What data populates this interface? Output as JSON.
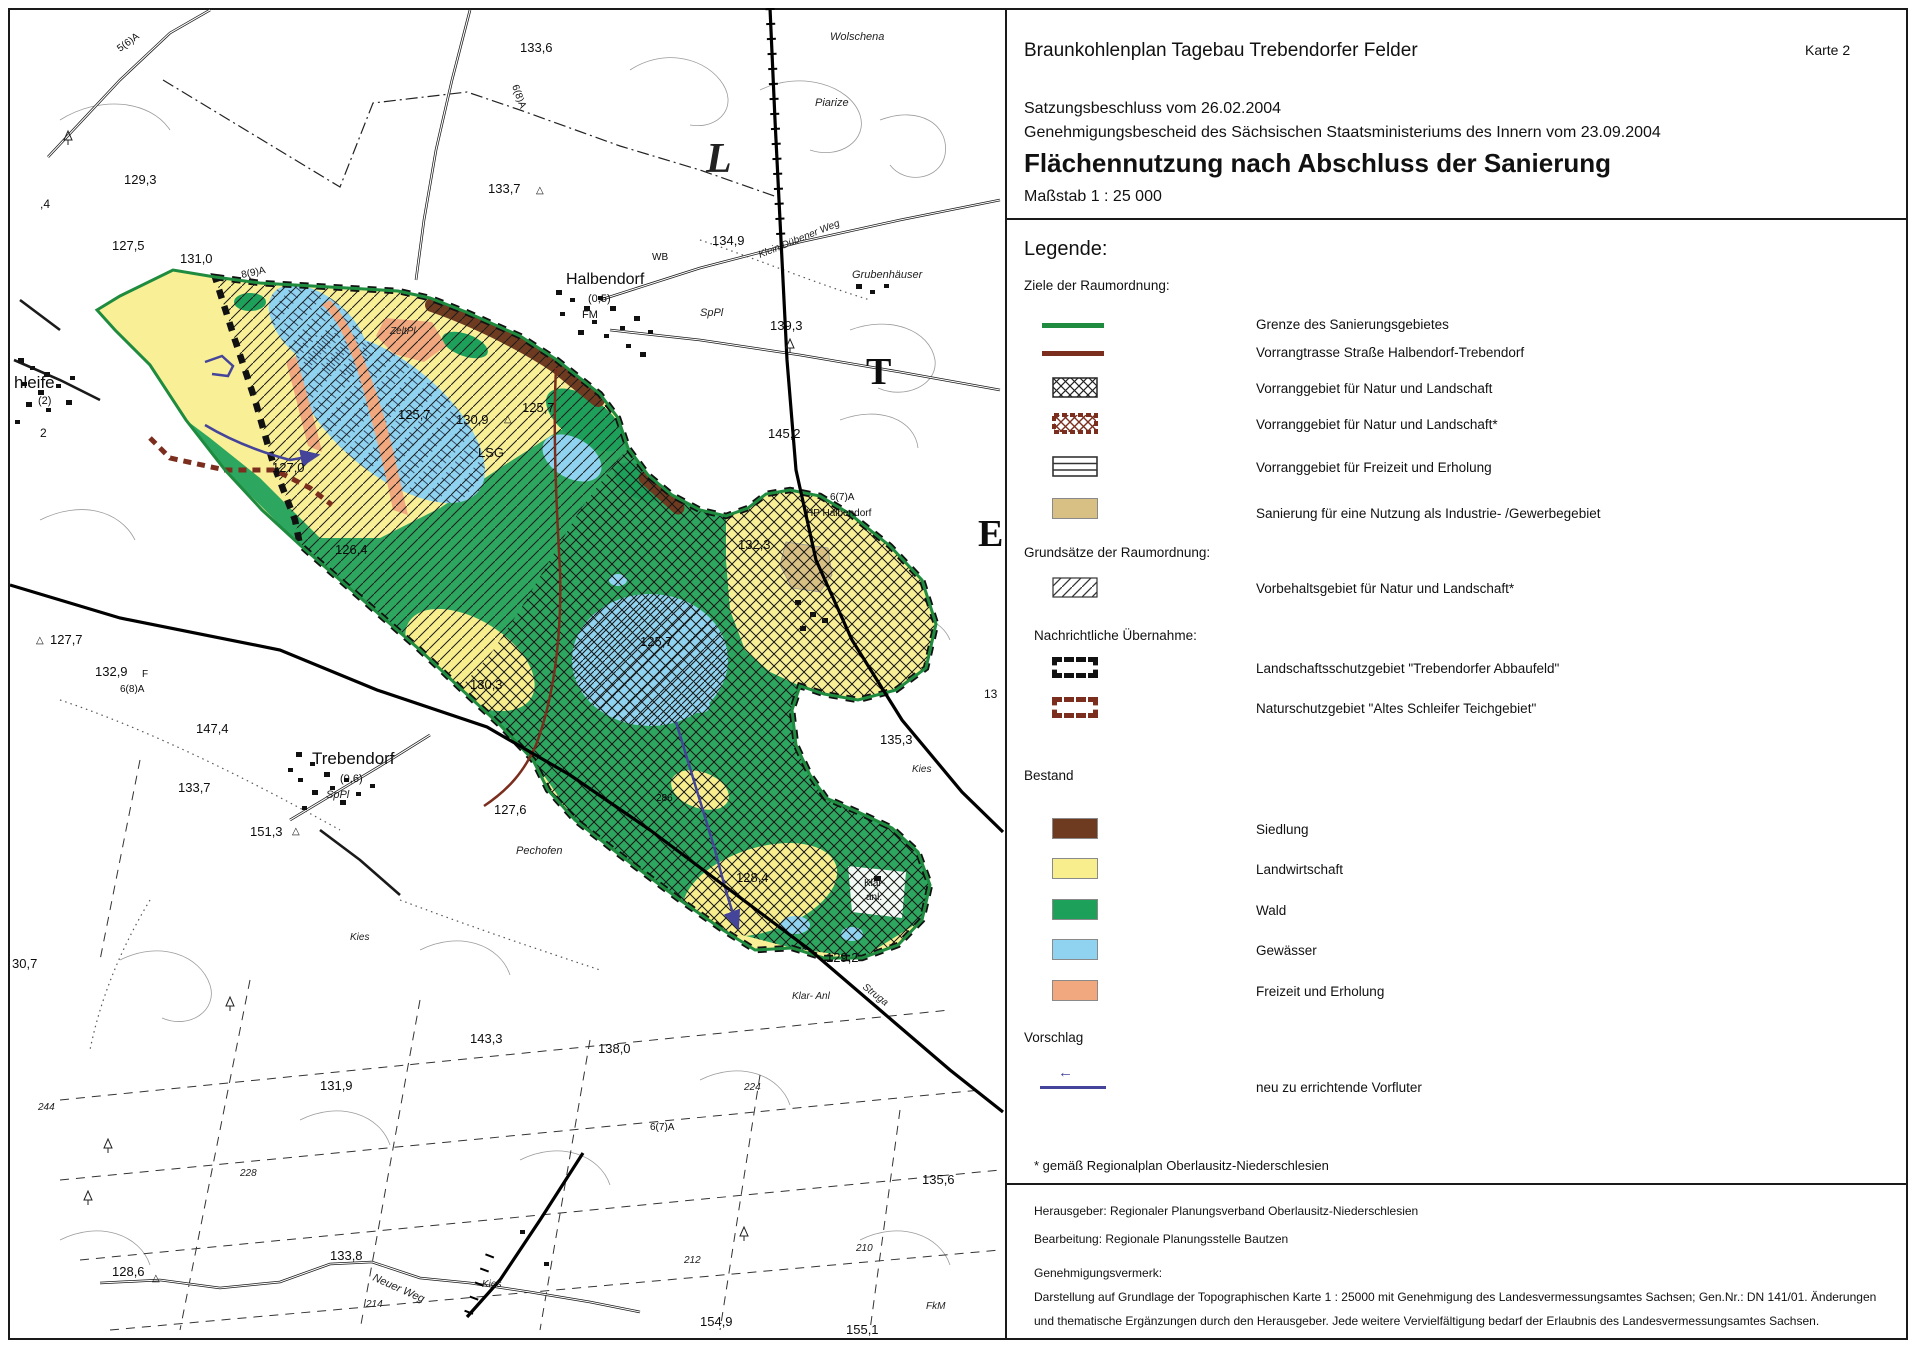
{
  "header": {
    "title": "Braunkohlenplan Tagebau Trebendorfer Felder",
    "karte": "Karte 2",
    "line1": "Satzungsbeschluss vom 26.02.2004",
    "line2": "Genehmigungsbescheid des Sächsischen Staatsministeriums des Innern vom 23.09.2004",
    "subject": "Flächennutzung nach Abschluss der Sanierung",
    "scale": "Maßstab 1 : 25 000"
  },
  "legend": {
    "heading": "Legende:",
    "ziele_heading": "Ziele der Raumordnung:",
    "grenze": "Grenze des Sanierungsgebietes",
    "vorrangtrasse": "Vorrangtrasse Straße Halbendorf-Trebendorf",
    "vorrang_natur": "Vorranggebiet für Natur und Landschaft",
    "vorrang_natur_star": "Vorranggebiet für Natur und Landschaft*",
    "vorrang_freizeit": "Vorranggebiet für Freizeit und Erholung",
    "sanierung_industrie": "Sanierung für eine Nutzung als Industrie- /Gewerbegebiet",
    "grundsaetze_heading": "Grundsätze der Raumordnung:",
    "vorbehalt": "Vorbehaltsgebiet für Natur und Landschaft*",
    "nachrichtlich_heading": "Nachrichtliche Übernahme:",
    "lsg": "Landschaftsschutzgebiet \"Trebendorfer Abbaufeld\"",
    "nsg": "Naturschutzgebiet \"Altes Schleifer Teichgebiet\"",
    "bestand_heading": "Bestand",
    "siedlung": "Siedlung",
    "landwirtschaft": "Landwirtschaft",
    "wald": "Wald",
    "gewaesser": "Gewässer",
    "freizeit": "Freizeit und Erholung",
    "vorschlag_heading": "Vorschlag",
    "vorfluter": "neu zu errichtende Vorfluter",
    "footnote": "* gemäß Regionalplan Oberlausitz-Niederschlesien"
  },
  "imprint": {
    "line1": "Herausgeber: Regionaler Planungsverband Oberlausitz-Niederschlesien",
    "line2": "Bearbeitung: Regionale Planungsstelle Bautzen",
    "line3": "Genehmigungsvermerk:",
    "line4": "Darstellung auf Grundlage der Topographischen Karte 1 : 25000 mit Genehmigung des Landesvermessungsamtes Sachsen; Gen.Nr.: DN 141/01. Änderungen",
    "line5": "und thematische Ergänzungen durch den Herausgeber. Jede weitere Vervielfältigung bedarf der Erlaubnis des Landesvermessungsamtes Sachsen."
  },
  "colors": {
    "grenze": "#1e8b3f",
    "trasse": "#7b2e1d",
    "wald": "#1da05a",
    "landwirtschaft": "#f8ee8e",
    "gewaesser": "#90d3f0",
    "freizeit": "#f2a87e",
    "siedlung": "#6e3a20",
    "industrie": "#d8c085",
    "vorfluter": "#44449a"
  },
  "map": {
    "labels": [
      {
        "t": "133,6",
        "x": 520,
        "y": 52
      },
      {
        "t": "Wolschena",
        "x": 830,
        "y": 40,
        "fs": 11,
        "it": 1
      },
      {
        "t": "Piarize",
        "x": 815,
        "y": 106,
        "fs": 11,
        "it": 1
      },
      {
        "t": "133,7",
        "x": 488,
        "y": 193
      },
      {
        "t": "△",
        "x": 536,
        "y": 193,
        "fs": 10
      },
      {
        "t": "134,9",
        "x": 712,
        "y": 245
      },
      {
        "t": "Klein Dübener Weg",
        "x": 760,
        "y": 258,
        "fs": 10,
        "it": 1,
        "rot": -22
      },
      {
        "t": "WB",
        "x": 652,
        "y": 260,
        "fs": 10
      },
      {
        "t": "Halbendorf",
        "x": 566,
        "y": 284,
        "fs": 16
      },
      {
        "t": "(0,5)",
        "x": 588,
        "y": 302,
        "fs": 11
      },
      {
        "t": "FM",
        "x": 582,
        "y": 318,
        "fs": 11
      },
      {
        "t": "SpPl",
        "x": 700,
        "y": 316,
        "fs": 11,
        "it": 1
      },
      {
        "t": "139,3",
        "x": 770,
        "y": 330
      },
      {
        "t": "Grubenhäuser",
        "x": 852,
        "y": 278,
        "fs": 11,
        "it": 1
      },
      {
        "t": "129,3",
        "x": 124,
        "y": 184
      },
      {
        "t": "127,5",
        "x": 112,
        "y": 250
      },
      {
        "t": "131,0",
        "x": 180,
        "y": 263
      },
      {
        "t": "5(6)A",
        "x": 120,
        "y": 52,
        "fs": 10,
        "rot": -36
      },
      {
        "t": ",4",
        "x": 40,
        "y": 208,
        "fs": 12
      },
      {
        "t": "6(8)A",
        "x": 512,
        "y": 86,
        "fs": 10,
        "rot": 70
      },
      {
        "t": "8(9)A",
        "x": 242,
        "y": 278,
        "fs": 10,
        "rot": -12
      },
      {
        "t": "L",
        "x": 706,
        "y": 172,
        "fs": 42,
        "big": 1,
        "it": 1
      },
      {
        "t": "T",
        "x": 866,
        "y": 384,
        "fs": 38,
        "big": 1
      },
      {
        "t": "E",
        "x": 978,
        "y": 546,
        "fs": 38,
        "big": 1
      },
      {
        "t": "hleife",
        "x": 14,
        "y": 388,
        "fs": 17
      },
      {
        "t": "(2)",
        "x": 38,
        "y": 404,
        "fs": 11
      },
      {
        "t": "2",
        "x": 40,
        "y": 437,
        "fs": 12
      },
      {
        "t": "ZeltPl",
        "x": 390,
        "y": 334,
        "fs": 10,
        "it": 1
      },
      {
        "t": "125,7",
        "x": 398,
        "y": 419
      },
      {
        "t": "130,9",
        "x": 456,
        "y": 424
      },
      {
        "t": "△",
        "x": 504,
        "y": 422,
        "fs": 10
      },
      {
        "t": "125,7",
        "x": 522,
        "y": 412
      },
      {
        "t": "LSG",
        "x": 478,
        "y": 457,
        "fs": 13
      },
      {
        "t": "145,2",
        "x": 768,
        "y": 438
      },
      {
        "t": "6(7)A",
        "x": 830,
        "y": 500,
        "fs": 10
      },
      {
        "t": "HP Halbendorf",
        "x": 806,
        "y": 516,
        "fs": 10
      },
      {
        "t": "132,3",
        "x": 738,
        "y": 549
      },
      {
        "t": "127,0",
        "x": 272,
        "y": 472
      },
      {
        "t": "126,4",
        "x": 335,
        "y": 554
      },
      {
        "t": "127,7",
        "x": 50,
        "y": 644
      },
      {
        "t": "△",
        "x": 36,
        "y": 643,
        "fs": 10
      },
      {
        "t": "132,9",
        "x": 95,
        "y": 676
      },
      {
        "t": "F",
        "x": 142,
        "y": 677,
        "fs": 10
      },
      {
        "t": "6(8)A",
        "x": 120,
        "y": 692,
        "fs": 10
      },
      {
        "t": "147,4",
        "x": 196,
        "y": 733
      },
      {
        "t": "Trebendorf",
        "x": 312,
        "y": 764,
        "fs": 17
      },
      {
        "t": "(0,6)",
        "x": 340,
        "y": 782,
        "fs": 11
      },
      {
        "t": "SpPl",
        "x": 326,
        "y": 798,
        "fs": 11,
        "it": 1
      },
      {
        "t": "133,7",
        "x": 178,
        "y": 792
      },
      {
        "t": "151,3",
        "x": 250,
        "y": 836
      },
      {
        "t": "△",
        "x": 292,
        "y": 834,
        "fs": 10
      },
      {
        "t": "Pechofen",
        "x": 516,
        "y": 854,
        "fs": 11,
        "it": 1
      },
      {
        "t": "125,7",
        "x": 640,
        "y": 646
      },
      {
        "t": "130,3",
        "x": 470,
        "y": 689
      },
      {
        "t": "135,3",
        "x": 880,
        "y": 744
      },
      {
        "t": "Kies",
        "x": 912,
        "y": 772,
        "fs": 10,
        "it": 1
      },
      {
        "t": "127,6",
        "x": 494,
        "y": 814
      },
      {
        "t": "286",
        "x": 656,
        "y": 801,
        "fs": 10
      },
      {
        "t": "128,4",
        "x": 736,
        "y": 882
      },
      {
        "t": "Klär-",
        "x": 864,
        "y": 886,
        "fs": 10
      },
      {
        "t": "anl.",
        "x": 866,
        "y": 900,
        "fs": 10
      },
      {
        "t": "Struga",
        "x": 862,
        "y": 988,
        "fs": 10,
        "it": 1,
        "rot": 38
      },
      {
        "t": "129,2",
        "x": 826,
        "y": 962
      },
      {
        "t": "Klar- Anl",
        "x": 792,
        "y": 999,
        "fs": 10,
        "it": 1
      },
      {
        "t": "143,3",
        "x": 470,
        "y": 1043
      },
      {
        "t": "138,0",
        "x": 598,
        "y": 1053
      },
      {
        "t": "131,9",
        "x": 320,
        "y": 1090
      },
      {
        "t": "30,7",
        "x": 12,
        "y": 968
      },
      {
        "t": "244",
        "x": 38,
        "y": 1110,
        "fs": 10,
        "it": 1
      },
      {
        "t": "228",
        "x": 240,
        "y": 1176,
        "fs": 10,
        "it": 1
      },
      {
        "t": "224",
        "x": 744,
        "y": 1090,
        "fs": 10,
        "it": 1
      },
      {
        "t": "6(7)A",
        "x": 650,
        "y": 1130,
        "fs": 10
      },
      {
        "t": "135,6",
        "x": 922,
        "y": 1184
      },
      {
        "t": "Kies",
        "x": 350,
        "y": 940,
        "fs": 10,
        "it": 1
      },
      {
        "t": "212",
        "x": 684,
        "y": 1263,
        "fs": 10,
        "it": 1
      },
      {
        "t": "210",
        "x": 856,
        "y": 1251,
        "fs": 10,
        "it": 1
      },
      {
        "t": "133,8",
        "x": 330,
        "y": 1260
      },
      {
        "t": "128,6",
        "x": 112,
        "y": 1276
      },
      {
        "t": "△",
        "x": 152,
        "y": 1281,
        "fs": 10
      },
      {
        "t": "Neuer Weg",
        "x": 372,
        "y": 1280,
        "fs": 11,
        "it": 1,
        "rot": 24
      },
      {
        "t": "214",
        "x": 366,
        "y": 1307,
        "fs": 10,
        "it": 1
      },
      {
        "t": "Kies",
        "x": 482,
        "y": 1287,
        "fs": 10,
        "it": 1
      },
      {
        "t": "154,9",
        "x": 700,
        "y": 1326
      },
      {
        "t": "155,1",
        "x": 846,
        "y": 1334
      },
      {
        "t": "FkM",
        "x": 926,
        "y": 1309,
        "fs": 10,
        "it": 1
      },
      {
        "t": "13",
        "x": 984,
        "y": 698,
        "fs": 12
      }
    ]
  }
}
